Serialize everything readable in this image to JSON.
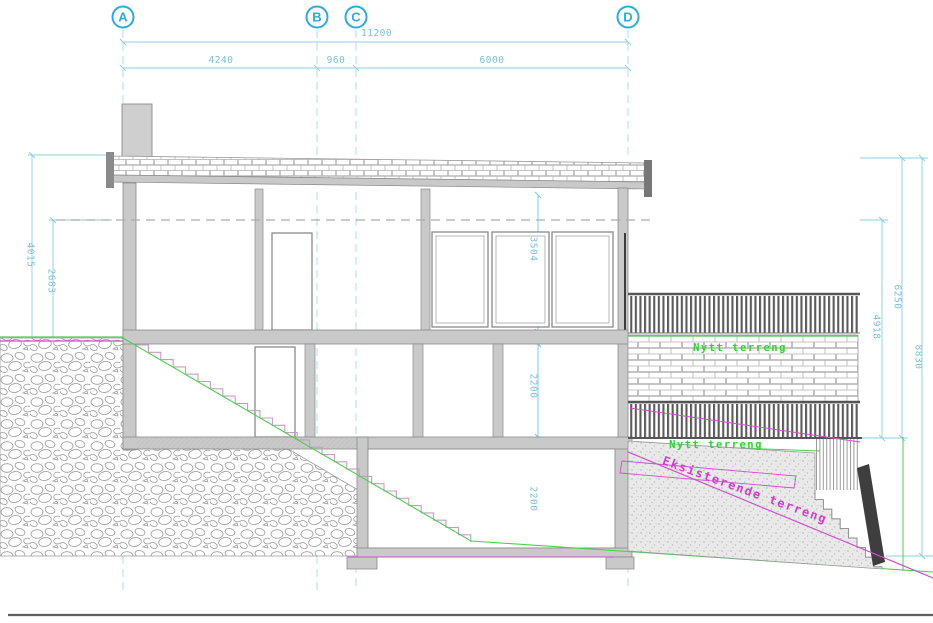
{
  "drawing_type": "building-section-elevation",
  "axes": [
    "A",
    "B",
    "C",
    "D"
  ],
  "dimensions": {
    "top_overall": "11200",
    "top_segments": [
      "4240",
      "960",
      "6000"
    ],
    "left": [
      "4015",
      "2683"
    ],
    "interior": [
      "3504",
      "2200",
      "2200"
    ],
    "right": [
      "4918",
      "6250",
      "8830"
    ]
  },
  "labels": {
    "new_terrain_upper": "Nytt terreng",
    "new_terrain_lower": "Nytt terreng",
    "existing_terrain": "Eksisterende terreng"
  },
  "colors": {
    "axis_cyan": "#2fa9de",
    "dimension_cyan": "#7dbed6",
    "new_terrain_green": "#2ed32e",
    "existing_terrain_magenta": "#cf3fcf",
    "wall_gray": "#c9c9c9"
  }
}
